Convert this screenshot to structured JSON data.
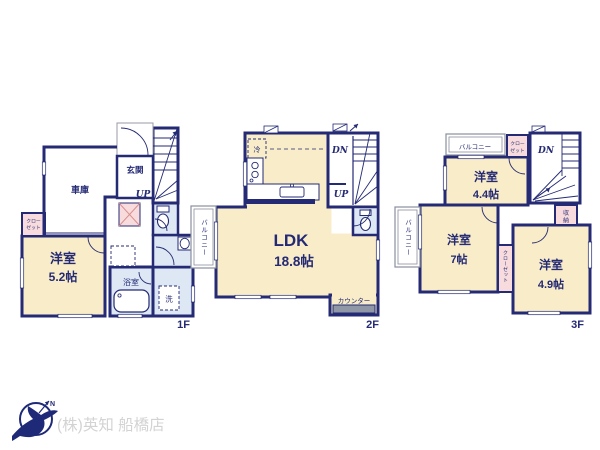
{
  "colors": {
    "wall": "#242a74",
    "room_cream": "#f9ecc8",
    "wet_blue": "#dde8f4",
    "closet_pink": "#f8dcdd",
    "counter_gray": "#9097a6",
    "balcony_rail_gray": "#8a8f9c",
    "logo_navy": "#1e2a78",
    "logo_text_gray": "#d3d3d3"
  },
  "floors": {
    "f1": {
      "label": "1F",
      "garage": "車庫",
      "entrance": "玄関",
      "up": "UP",
      "closet_line1": "クロー",
      "closet_line2": "ゼット",
      "room1_name": "洋室",
      "room1_size": "5.2帖",
      "bath": "浴室",
      "laundry": "洗"
    },
    "f2": {
      "label": "2F",
      "fridge": "冷",
      "dn": "DN",
      "up": "UP",
      "balcony": "バルコニー",
      "ldk_name": "LDK",
      "ldk_size": "18.8帖",
      "counter": "カウンター"
    },
    "f3": {
      "label": "3F",
      "balcony_top": "バルコニー",
      "balcony_left": "バルコニー",
      "closet_line1": "クロー",
      "closet_line2": "ゼット",
      "dn": "DN",
      "room1_name": "洋室",
      "room1_size": "4.4帖",
      "storage_line1": "収",
      "storage_line2": "納",
      "room2_name": "洋室",
      "room2_size": "7帖",
      "closet_vert": "クローゼット",
      "room3_name": "洋室",
      "room3_size": "4.9帖"
    }
  },
  "footer": {
    "company": "(株)英知 船橋店"
  }
}
